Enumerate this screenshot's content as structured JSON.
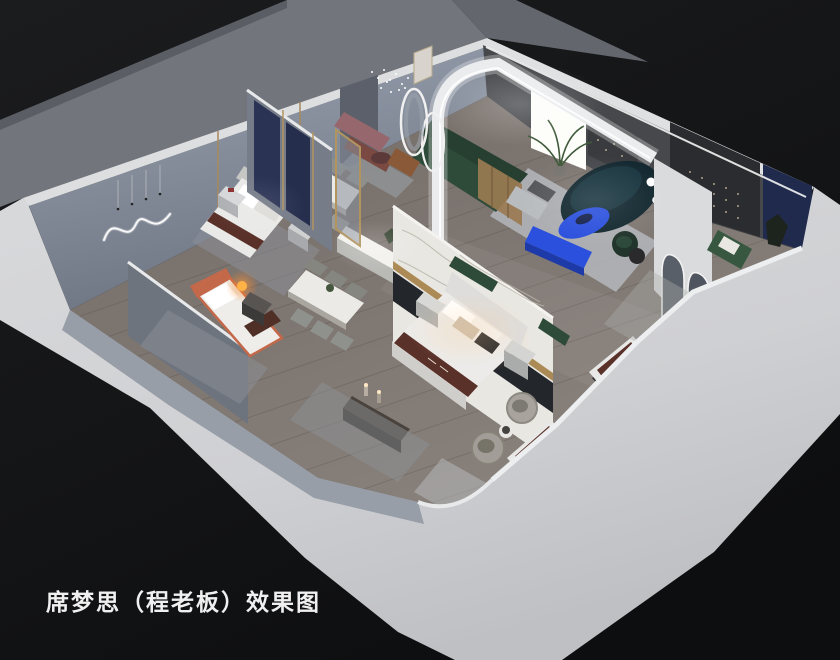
{
  "scene": {
    "caption": "席梦思（程老板）效果图",
    "description": "isometric cutaway 3D rendering of a mattress showroom interior"
  },
  "palette": {
    "background_dark": "#161719",
    "background_corner": "#0d0e0f",
    "terrace_gray": "#72757c",
    "wall_band": "#d2d3d6",
    "wall_band_deep": "#c0c1c5",
    "wall_top": "#e3e4e6",
    "interior_wall_blue": "#939cab",
    "interior_wall_shadow": "#6f7683",
    "floor_wood": "#7e7671",
    "marble_white": "#e9e7e2",
    "gold_trim": "#ab8a55",
    "accent_blue": "#2b50dd",
    "accent_blue_deep": "#1d3aa8",
    "sofa_green": "#2e4a38",
    "sofa_teal_dark": "#132830",
    "armchair_green": "#375741",
    "bed_orange": "#c4684a",
    "mattress_brown": "#5a3129",
    "navy_panel": "#202a4d",
    "navy_fabric": "#2b3355",
    "mauve_bench": "#96676d",
    "cognac_chair": "#8a5a38",
    "rug_gray": "#b8bcc2",
    "lamp_warm": "#ffb347",
    "led_white": "#ffffff",
    "caption_white": "#f0f0f0"
  },
  "objects": [
    "double-bed-gray-room",
    "double-bed-marble-room",
    "single-bed-orange",
    "mattress-display-1",
    "mattress-display-2",
    "dining-table-6-chairs",
    "dining-table-4-chairs",
    "green-sectional-sofa",
    "dark-teal-curved-sofa",
    "blue-coffee-table",
    "blue-tv-bench",
    "marble-partition",
    "arch-led-wall",
    "arched-mirrors",
    "oval-mirrors",
    "swivel-barrel-chairs",
    "squiggle-neon-light",
    "string-lights",
    "crystal-pendant",
    "floor-lamps",
    "mauve-bench",
    "cognac-armchair",
    "green-armchair",
    "plants"
  ]
}
